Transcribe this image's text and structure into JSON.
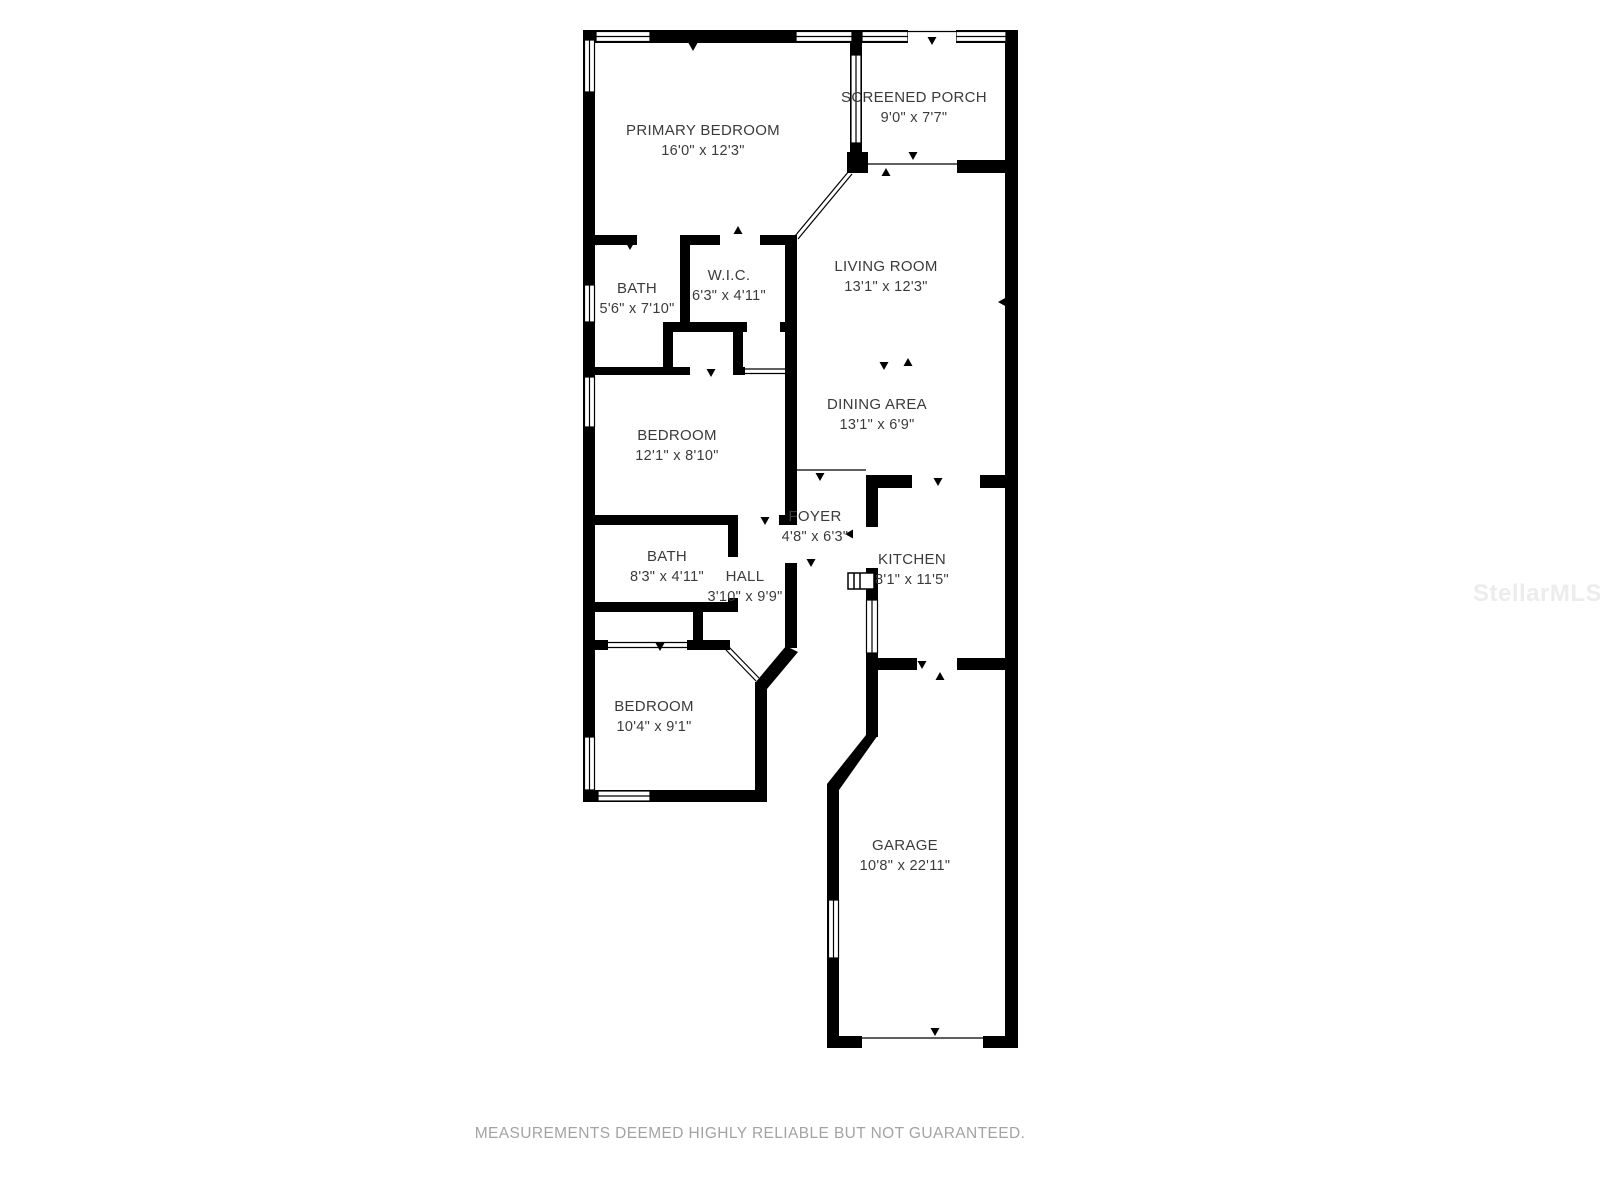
{
  "page": {
    "footer_text": "MEASUREMENTS DEEMED HIGHLY RELIABLE BUT NOT GUARANTEED.",
    "watermark": "StellarMLS"
  },
  "colors": {
    "background": "#ffffff",
    "wall": "#000000",
    "room_label": "#3b3b3b",
    "footer": "#a3a3a3",
    "watermark": "#ececec"
  },
  "rooms": {
    "primary_bedroom": {
      "name": "PRIMARY BEDROOM",
      "dims": "16'0\" x 12'3\""
    },
    "screened_porch": {
      "name": "SCREENED PORCH",
      "dims": "9'0\" x 7'7\""
    },
    "bath_1": {
      "name": "BATH",
      "dims": "5'6\" x 7'10\""
    },
    "wic": {
      "name": "W.I.C.",
      "dims": "6'3\" x 4'11\""
    },
    "living_room": {
      "name": "LIVING ROOM",
      "dims": "13'1\" x 12'3\""
    },
    "dining_area": {
      "name": "DINING AREA",
      "dims": "13'1\" x 6'9\""
    },
    "bedroom_2": {
      "name": "BEDROOM",
      "dims": "12'1\" x 8'10\""
    },
    "foyer": {
      "name": "FOYER",
      "dims": "4'8\" x 6'3\""
    },
    "bath_2": {
      "name": "BATH",
      "dims": "8'3\" x 4'11\""
    },
    "hall": {
      "name": "HALL",
      "dims": "3'10\" x 9'9\""
    },
    "kitchen": {
      "name": "KITCHEN",
      "dims": "8'1\" x 11'5\""
    },
    "bedroom_3": {
      "name": "BEDROOM",
      "dims": "10'4\" x 9'1\""
    },
    "garage": {
      "name": "GARAGE",
      "dims": "10'8\" x 22'11\""
    }
  }
}
